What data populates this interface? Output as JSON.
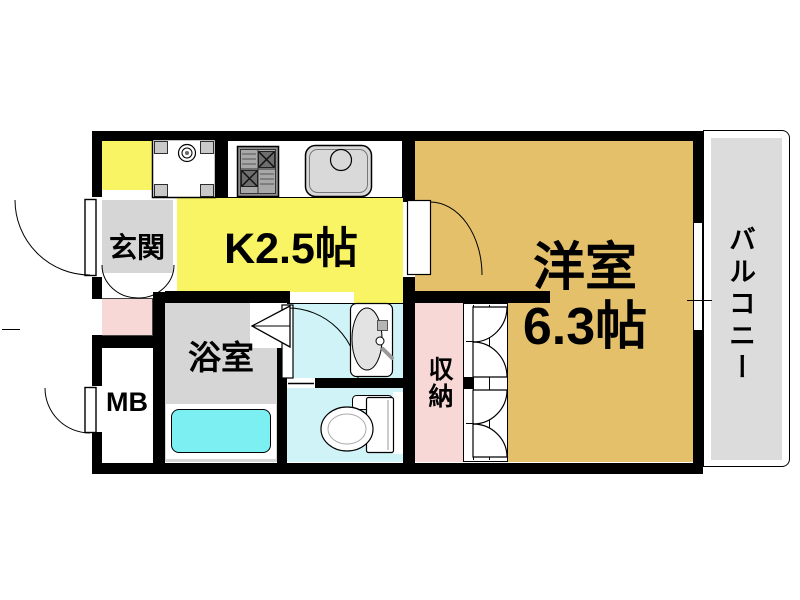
{
  "floorplan": {
    "rooms": {
      "entrance": {
        "label": "玄関"
      },
      "kitchen": {
        "label": "K2.5帖"
      },
      "western_room": {
        "label": "洋室",
        "size": "6.3帖"
      },
      "balcony": {
        "label": "バルコニー"
      },
      "bathroom": {
        "label": "浴室"
      },
      "meter_box": {
        "label": "MB"
      },
      "storage": {
        "label": "収納"
      }
    },
    "colors": {
      "wall": "#000000",
      "kitchen": "#f8f463",
      "western_room": "#e4c06b",
      "entrance": "#d6d6d6",
      "bathroom": "#d6d6d6",
      "balcony_floor": "#dcdcdc",
      "storage": "#f8d7d7",
      "sanitary_floor": "#cff3f7",
      "bathtub": "#7ceff2"
    }
  }
}
